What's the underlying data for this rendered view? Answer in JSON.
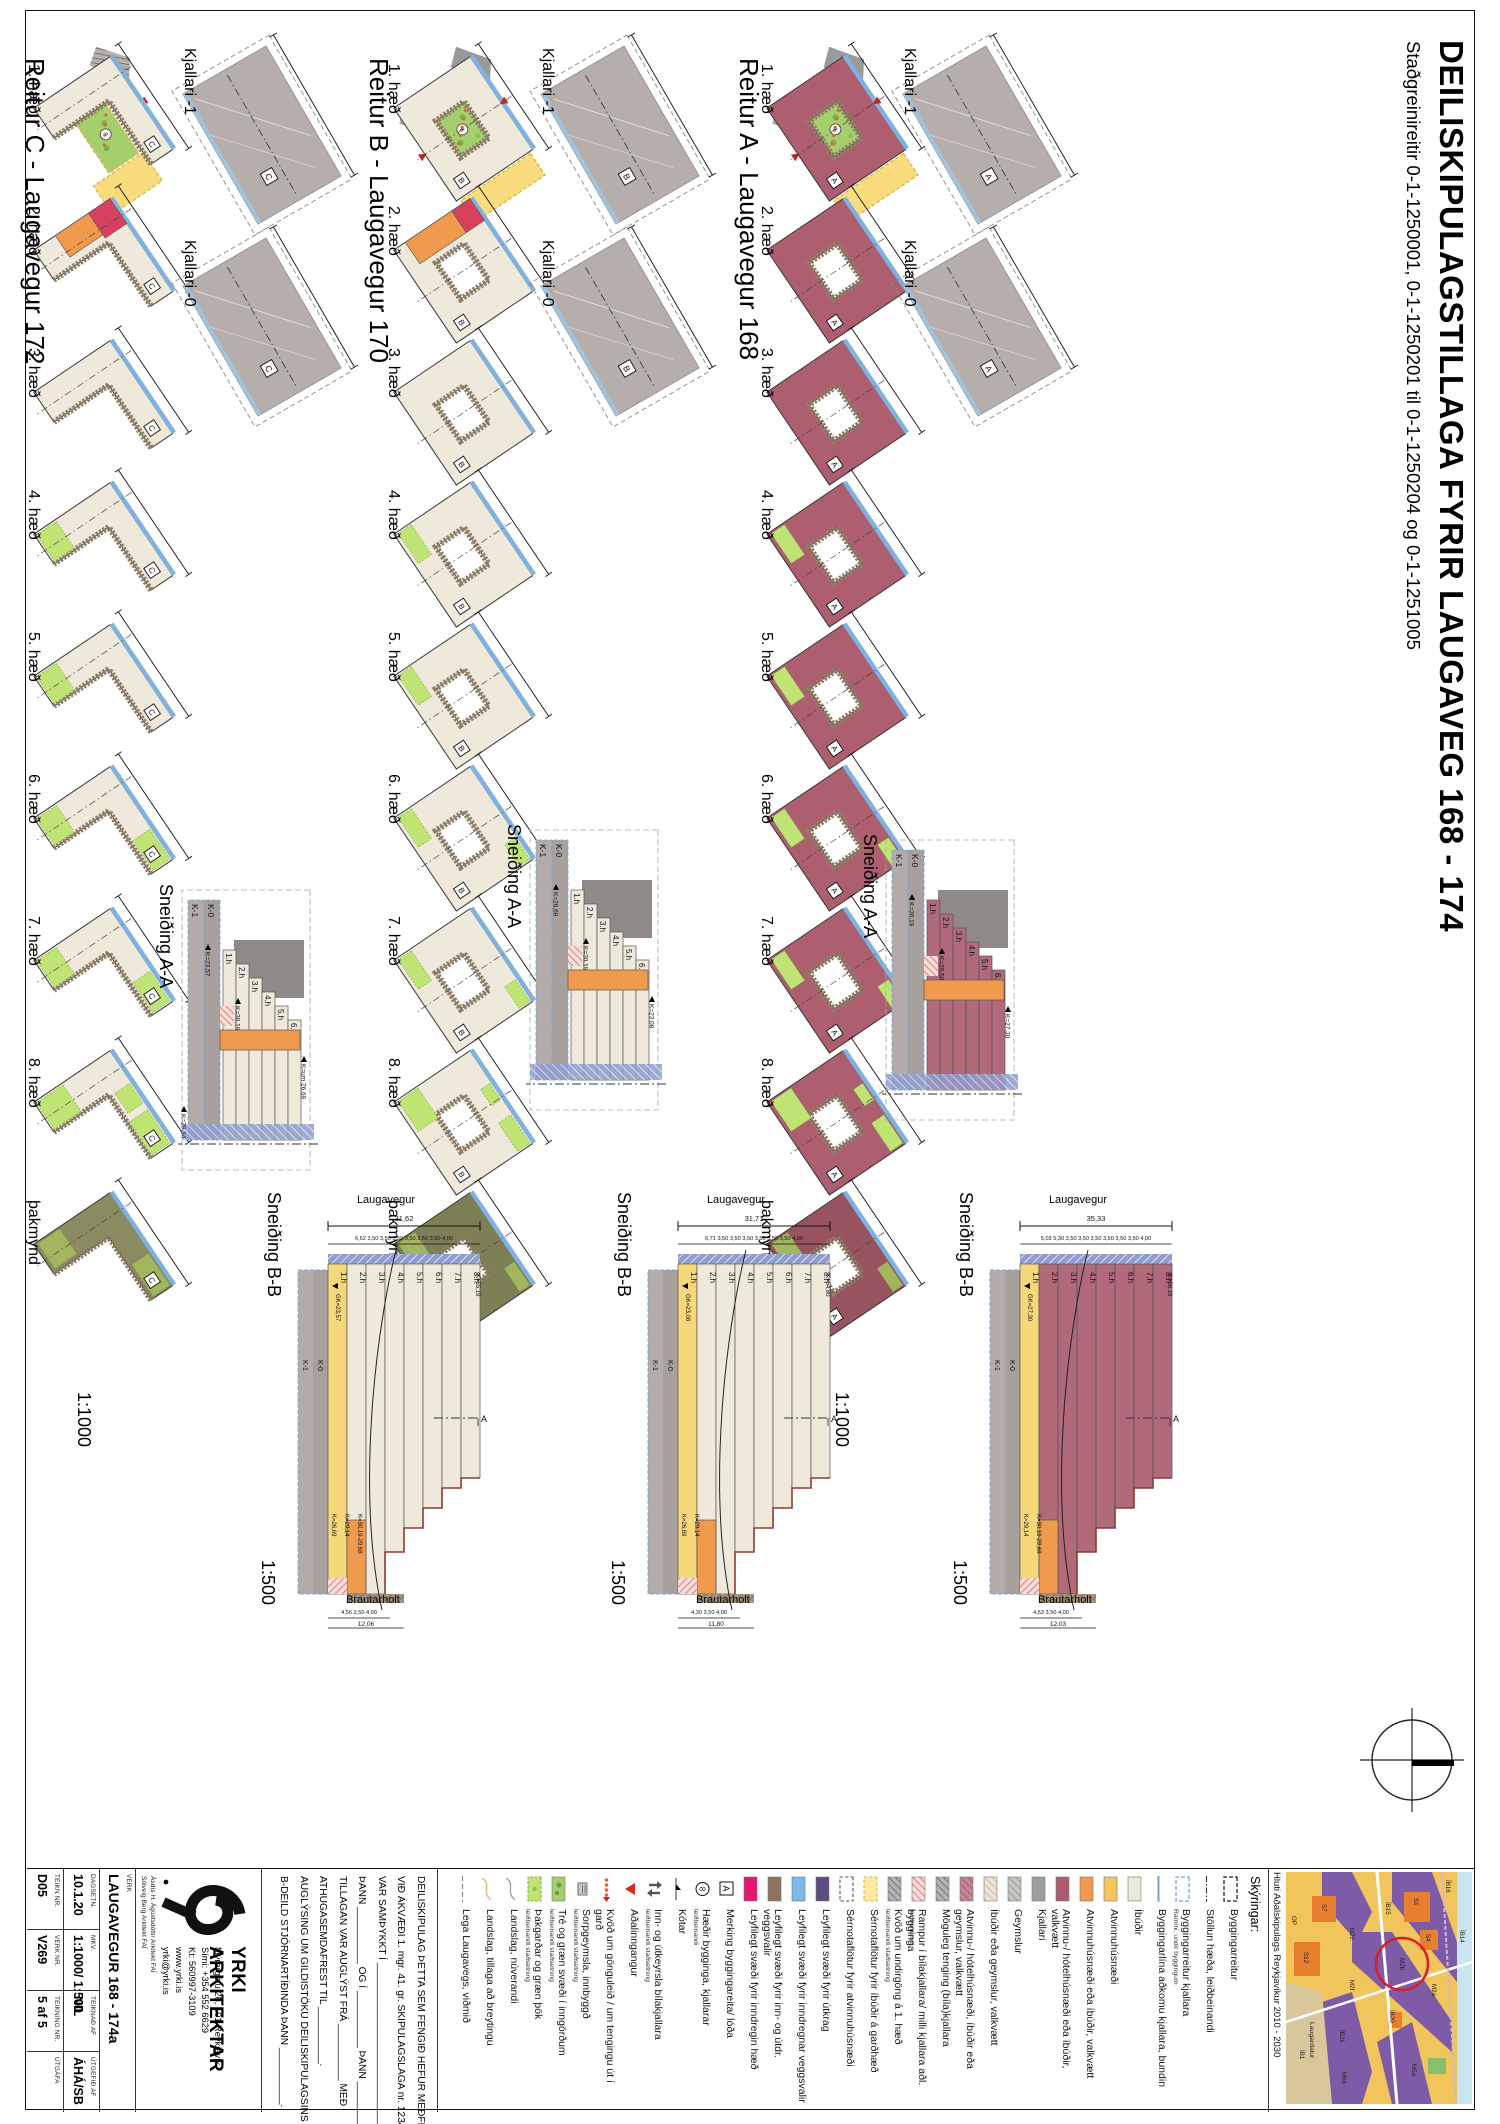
{
  "sheet": {
    "title": "DEILISKIPULAGSTILLAGA FYRIR LAUGAVEG 168 - 174",
    "subtitle": "Staðgreinireitir 0-1-1250001, 0-1-1250201 til 0-1-1250204 og 0-1-1251005"
  },
  "rows": [
    {
      "id": "A",
      "header": "Reitur A - Laugavegur 168",
      "letter": "A",
      "shape": "ring",
      "storeys": "8",
      "colors": {
        "fill": "#ad5f6f",
        "roof": "#97545f",
        "edge": "#7fb2e0",
        "band": "#8f7d66"
      },
      "floors": [
        {
          "label": "1. hæð",
          "variant": "ground"
        },
        {
          "label": "2. hæð",
          "variant": "second"
        },
        {
          "label": "3. hæð",
          "variant": "plain"
        },
        {
          "label": "4. hæð",
          "variant": "g1"
        },
        {
          "label": "5. hæð",
          "variant": "g1"
        },
        {
          "label": "6. hæð",
          "variant": "g2"
        },
        {
          "label": "7. hæð",
          "variant": "g2"
        },
        {
          "label": "8. hæð",
          "variant": "g3"
        },
        {
          "label": "þakmynd",
          "variant": "roof"
        }
      ],
      "kjallari": [
        {
          "label": "Kjallari -1"
        },
        {
          "label": "Kjallari -0"
        }
      ],
      "scale_plans": "1:1000",
      "scale_sections": "1:500",
      "section_aa": {
        "label": "Sneiðing A-A",
        "basements": [
          "K-1",
          "K-0"
        ],
        "floor_labels": [
          "1.h",
          "2.h",
          "3.h",
          "4.h",
          "5.h",
          "6.h"
        ],
        "kotar": [
          "K=27,30",
          "K=30,19",
          "K=29,50"
        ]
      },
      "section_bb": {
        "label": "Sneiðing B-B",
        "street_top": "Laugavegur",
        "street_bottom": "Brautarholt",
        "dim_total": "35,33",
        "dims_top": "5,03  5,30  3,50  3,50  3,50  3,50  3,50  3,50  4,00",
        "dims_bottom": "4,53  3,50  4,00",
        "dim_bottom_total": "12,03",
        "floor_labels": [
          "1.h",
          "2.h",
          "3.h",
          "4.h",
          "5.h",
          "6.h",
          "7.h",
          "8.h"
        ],
        "basements": [
          "K-1",
          "K-0"
        ],
        "kota_gk": "GK=27,30",
        "kota_top": "K=56,19",
        "kotar_bottom": [
          "K=29,14",
          "K=30,19-29,68"
        ],
        "cut_letter": "A"
      }
    },
    {
      "id": "B",
      "header": "Reitur B - Laugavegur 170",
      "letter": "B",
      "shape": "ring",
      "storeys": "8",
      "colors": {
        "fill": "#efe9dc",
        "roof": "#7e7f55",
        "edge": "#7fb2e0",
        "band": "#8f7d66"
      },
      "floors": [
        {
          "label": "1. hæð",
          "variant": "ground"
        },
        {
          "label": "2. hæð",
          "variant": "second"
        },
        {
          "label": "3. hæð",
          "variant": "plain"
        },
        {
          "label": "4. hæð",
          "variant": "g1"
        },
        {
          "label": "5. hæð",
          "variant": "g1"
        },
        {
          "label": "6. hæð",
          "variant": "g2"
        },
        {
          "label": "7. hæð",
          "variant": "g2"
        },
        {
          "label": "8. hæð",
          "variant": "g3"
        },
        {
          "label": "þakmynd",
          "variant": "roof"
        }
      ],
      "kjallari": [
        {
          "label": "Kjallari -1"
        },
        {
          "label": "Kjallari -0"
        }
      ],
      "scale_plans": "1:1000",
      "scale_sections": "1:500",
      "section_aa": {
        "label": "Sneiðing A-A",
        "basements": [
          "K-1",
          "K-0"
        ],
        "floor_labels": [
          "1.h",
          "2.h",
          "3.h",
          "4.h",
          "5.h",
          "6.h"
        ],
        "kotar": [
          "K=23,08",
          "K=26,69",
          "K=30,19"
        ]
      },
      "section_bb": {
        "label": "Sneiðing B-B",
        "street_top": "Laugavegur",
        "street_bottom": "Brautarholt",
        "dim_total": "31,71",
        "dims_top": "6,71  3,50  3,50  3,50  3,50  3,50  3,50  4,00",
        "dims_bottom": "4,30  3,50  4,00",
        "dim_bottom_total": "11,80",
        "floor_labels": [
          "1.h",
          "2.h",
          "3.h",
          "4.h",
          "5.h",
          "6.h",
          "7.h",
          "8.h"
        ],
        "basements": [
          "K-1",
          "K-0"
        ],
        "kota_gk": "GK=23,08",
        "kota_top": "K=54,80",
        "kotar_bottom": [
          "K=26,69",
          "K=29,14"
        ],
        "cut_letter": "A"
      }
    },
    {
      "id": "C",
      "header": "Reitur C - Laugavegur 172",
      "letter": "C",
      "shape": "L",
      "storeys": "8",
      "colors": {
        "fill": "#efe9dc",
        "roof": "#8a8b60",
        "edge": "#7fb2e0",
        "band": "#8f7d66"
      },
      "floors": [
        {
          "label": "1. hæð",
          "variant": "ground"
        },
        {
          "label": "2. hæð",
          "variant": "second"
        },
        {
          "label": "3. hæð",
          "variant": "plain"
        },
        {
          "label": "4. hæð",
          "variant": "g1"
        },
        {
          "label": "5. hæð",
          "variant": "g1"
        },
        {
          "label": "6. hæð",
          "variant": "g2"
        },
        {
          "label": "7. hæð",
          "variant": "g2"
        },
        {
          "label": "8. hæð",
          "variant": "g3"
        },
        {
          "label": "þakmynd",
          "variant": "roof"
        }
      ],
      "kjallari": [
        {
          "label": "Kjallari -1"
        },
        {
          "label": "Kjallari -0"
        }
      ],
      "scale_plans": "1:1000",
      "scale_sections": "1:500",
      "section_aa": {
        "label": "Sneiðing A-A",
        "basements": [
          "K-1",
          "K-0"
        ],
        "floor_labels": [
          "1.h",
          "2.h",
          "3.h",
          "4.h",
          "5.h",
          "6.h"
        ],
        "kotar": [
          "K=um 26,69",
          "K=23,57",
          "K=30,19",
          "K=29,14"
        ]
      },
      "section_bb": {
        "label": "Sneiðing B-B",
        "street_top": "Laugavegur",
        "street_bottom": "Brautarholt",
        "dim_total": "31,62",
        "dims_top": "6,62  3,50  3,50  3,50  3,50  3,50  3,50  4,00",
        "dims_bottom": "4,56  3,50  4,00",
        "dim_bottom_total": "12,06",
        "floor_labels": [
          "1.h",
          "2.h",
          "3.h",
          "4.h",
          "5.h",
          "6.h",
          "7.h",
          "8.h"
        ],
        "basements": [
          "K-1",
          "K-0"
        ],
        "kota_gk": "GK=23,57",
        "kota_top": "K=55,19",
        "kotar_bottom": [
          "K=26,69",
          "K=29,14",
          "K=30,19-29,68"
        ],
        "cut_letter": "A"
      }
    }
  ],
  "legend": {
    "heading": "Skýringar:",
    "items": [
      {
        "label": "Byggingarreitur",
        "sw": "outline"
      },
      {
        "label": "Stöllun hæða, leiðbeinandi",
        "sw": "dashdot"
      },
      {
        "label": "Byggingarreitur kjallara",
        "sub": "Rammi, undir byggingum",
        "sw": "outline-blue"
      },
      {
        "label": "Byggingarlína aðkomu kjallara, bundin",
        "sw": "line-blue"
      },
      {
        "label": "Íbúðir",
        "sw": "fill",
        "color": "#ece8da"
      },
      {
        "label": "Atvinnuhúsnæði",
        "sw": "fill",
        "color": "#f4c55f"
      },
      {
        "label": "Atvinnuhúsnæði eða íbúðir, valkvætt",
        "sw": "fill",
        "color": "#ef9a4d"
      },
      {
        "label": "Atvinnu-/ hótelhúsnæði eða íbúðir, valkvætt",
        "sw": "fill",
        "color": "#ad5c6d"
      },
      {
        "label": "Kjallari",
        "sw": "fill",
        "color": "#9d9d9d"
      },
      {
        "label": "Geymslur",
        "sw": "hatch",
        "pat": "phGray"
      },
      {
        "label": "Íbúðir eða geymslur, valkvætt",
        "sw": "hatch",
        "pat": "phCream"
      },
      {
        "label": "Atvinnu-/ hótelhúsnæði, íbúðir eða geymslur, valkvætt",
        "sw": "hatch",
        "pat": "phMaroon"
      },
      {
        "label": "Möguleg tenging (bíla)kjallara",
        "sw": "hatch",
        "pat": "phDark"
      },
      {
        "label": "Rampur í bílakjallara/ milli kjallara aðl. bygginga",
        "sub": "leiðbeinandi",
        "sw": "hatch",
        "pat": "phRed"
      },
      {
        "label": "Kvöð um undirgöng á 1. hæð",
        "sub": "leiðbeinandi staðsetning",
        "sw": "hatch",
        "pat": "phDark"
      },
      {
        "label": "Sérnotaflötur fyrir íbúðir á garðhæð",
        "sw": "dashfill",
        "color": "#fbe9a6",
        "border": "#e3b93e"
      },
      {
        "label": "Sérnotaflötur fyrir atvinnuhúsnæði",
        "sw": "dashfill",
        "color": "#ffffff",
        "border": "#555555"
      },
      {
        "label": "Leyfilegt svæði fyrir útkrag",
        "sw": "fill",
        "color": "#5d4b82"
      },
      {
        "label": "Leyfilegt svæði fyrir inndregnar veggsvalir",
        "sw": "fill",
        "color": "#7cb9e8"
      },
      {
        "label": "Leyfilegt svæði fyrir inn- og útdr. veggsvalir",
        "sw": "fill",
        "color": "#8b7360"
      },
      {
        "label": "Leyfilegt svæði fyrir inndregin hæð",
        "sw": "fill",
        "color": "#e0186f"
      },
      {
        "label": "Merking byggingareita/ lóða",
        "sw": "abox",
        "glyph": "A"
      },
      {
        "label": "Hæðir bygginga, kjallarar",
        "sub": "leiðbeinandi",
        "sw": "circle",
        "glyph": "8"
      },
      {
        "label": "Kótar",
        "sw": "koti"
      },
      {
        "label": "Inn- og útkeyrsla bílakjallara",
        "sub": "leiðbeinandi staðsetning",
        "sw": "arrows"
      },
      {
        "label": "Aðalinngangur",
        "sw": "tri"
      },
      {
        "label": "Kvöð um gönguleið / um tengingu út í garð",
        "sw": "dots"
      },
      {
        "label": "Sorpgeymsla, innbyggð",
        "sub": "leiðbeinandi staðsetning",
        "sw": "sorp"
      },
      {
        "label": "Tré og græn svæði í inngörðum",
        "sub": "leiðbeinandi staðsetning",
        "sw": "green1"
      },
      {
        "label": "Þakgarðar og græn þök",
        "sub": "leiðbeinandi staðsetning",
        "sw": "green2"
      },
      {
        "label": "Landslag, núverandi",
        "sw": "curve",
        "color": "#9a9a9a"
      },
      {
        "label": "Landslag, tillaga að breytingu",
        "sw": "curve",
        "color": "#d8b46a"
      },
      {
        "label": "Lega Laugavegs, viðmið",
        "sw": "dashline"
      }
    ]
  },
  "titleblock": {
    "approval_lines": [
      "DEILISKIPULAG ÞETTA SEM FENGIÐ HEFUR MEÐFERÐ Í SAMRÆMI",
      "VIÐ ÁKVÆÐI 1. mgr. 41. gr. SKIPULAGSLAGA nr. 123/2010.",
      "VAR SAMÞYKKT Í _____________________________",
      "ÞANN __________ OG Í __________ ÞANN __________",
      "TILLAGAN VAR AUGLÝST FRÁ __________ MEÐ",
      "ATHUGASEMDAFREST TIL __________.",
      "AUGLÝSING UM GILDISTÖKU DEILISKIPULAGSINS VAR BIRT Í",
      "B-DEILD STJÓRNARTÍÐINDA ÞANN __________."
    ],
    "firm": {
      "name": "YRKI ARKITEKTAR",
      "address": "Mýrargötu 26, 101 Reykjavík",
      "phone": "Sími: +354 552 6629",
      "kt": "Kt: 560997-3109",
      "web": "www.yrki.is",
      "email": "yrki@yrki.is",
      "architect1": "Ásdís H. Ágústsdóttir Arkitekt FAÍ",
      "architect2": "Sólveig Berg Arkitekt FAÍ"
    },
    "fields": {
      "heiti_label": "VERK",
      "heiti": "LAUGAVEGUR 168 - 174a",
      "dags_label": "DAGSETN.",
      "dags": "10.1.20",
      "mkv_label": "MKV.",
      "mkv": "1:1000/ 1:500",
      "teiknad_label": "TEIKNAÐ AF",
      "teiknad": "NIL",
      "utgefid_label": "ÚTGEFIÐ AF",
      "utgefid": "ÁHÁ/SB",
      "teiknnr_label": "TEIKN NR.",
      "teiknnr": "D05",
      "verknr_label": "VERK NR.",
      "verknr": "V269",
      "teikning_label": "TEIKNING NR.",
      "teikning": "5 af 5",
      "utgafa_label": "ÚTGÁFA",
      "utgafa": ""
    },
    "map_caption": "Hluti Aðalskipulags Reykjavíkur 2010 - 2030",
    "map_labels": [
      "M2a",
      "M2b",
      "M2c",
      "M2f",
      "M5a",
      "M6b",
      "S1",
      "S4",
      "S7",
      "S12",
      "ÍB14",
      "ÍB15",
      "ÍB16",
      "ÍB20",
      "ÍB21",
      "ÍB1",
      "OP",
      "Laugardalur"
    ]
  }
}
